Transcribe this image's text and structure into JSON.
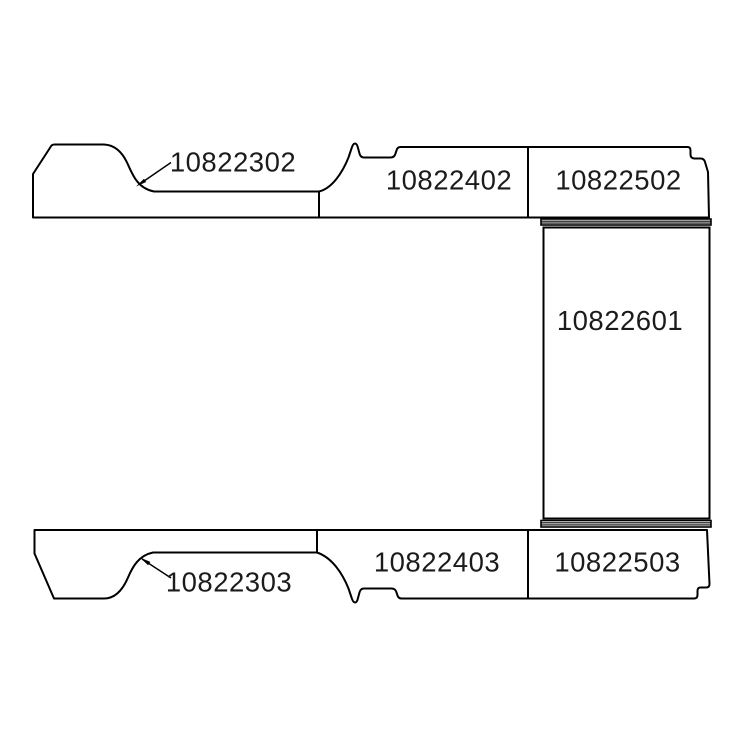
{
  "diagram": {
    "title": "van-floor-parts-diagram",
    "background_color": "#ffffff",
    "line_color": "#000000",
    "text_color": "#1b1b1b",
    "parts": {
      "top_left": "10822302",
      "top_middle": "10822402",
      "top_right": "10822502",
      "middle_right": "10822601",
      "bottom_left": "10822303",
      "bottom_middle": "10822403",
      "bottom_right": "10822503"
    }
  }
}
